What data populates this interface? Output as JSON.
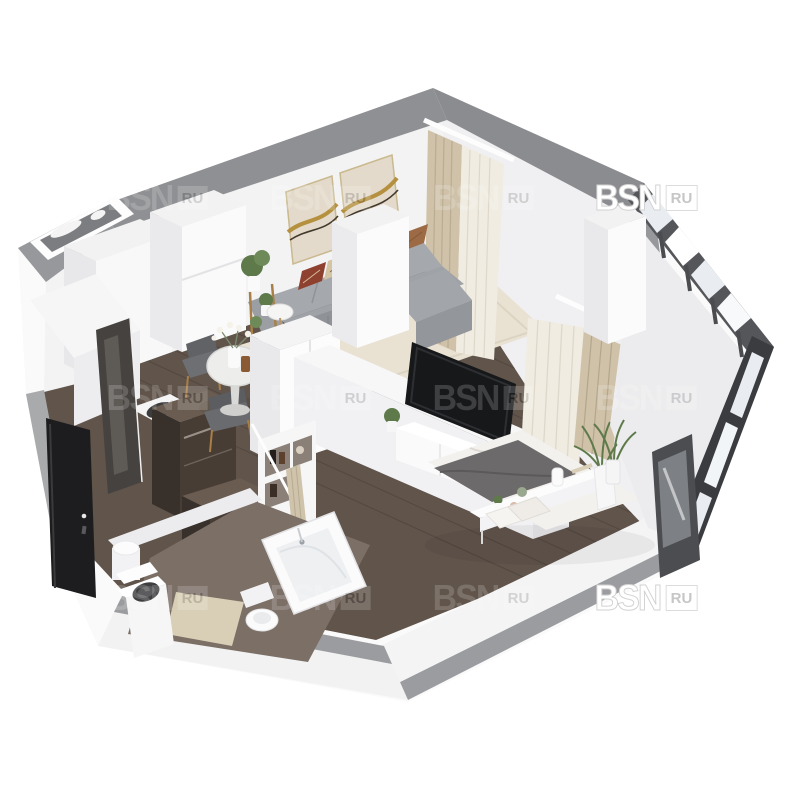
{
  "watermark": {
    "brand": "BSN",
    "domain": "RU",
    "grid": {
      "columns_x": [
        157,
        320,
        483,
        646
      ],
      "rows_y": [
        198,
        398,
        598
      ],
      "opaque_cells": [
        [
          3,
          0
        ],
        [
          3,
          2
        ]
      ],
      "faint_opacity": 0.17
    }
  },
  "palette": {
    "wall_top": "#8f9093",
    "wall_face": "#f3f3f4",
    "wall_inner": "#e9e9eb",
    "white": "#fbfbfc",
    "floor_wood": "#60544b",
    "floor_wood_dark": "#4a403a",
    "rug": "#e9e2d3",
    "sofa": "#9fa2a7",
    "sofa_shadow": "#8f9297",
    "pillow_rust": "#8f4130",
    "pillow_cream": "#d3c4a4",
    "pillow_red": "#8e3525",
    "pillow_brown": "#5a3b28",
    "pillow_ochre": "#9c6a44",
    "art_canvas": "#e3dacb",
    "art_gold": "#b4903f",
    "curtain_tan": "#cfc2a9",
    "curtain_sheer": "#f0ece2",
    "cabinet_dark": "#473d35",
    "cabinet_dark_side": "#38302a",
    "glass": "#e9edf1",
    "frame_dark": "#54565a",
    "plant_green": "#5e7a4b",
    "wood_accent": "#a97f48",
    "bed_linen": "#f3f1ee",
    "bed_throw": "#6d6a6b",
    "bath_floor": "#7b6f66",
    "mat_beige": "#d9cfb6",
    "door_black": "#1d1d1f"
  }
}
